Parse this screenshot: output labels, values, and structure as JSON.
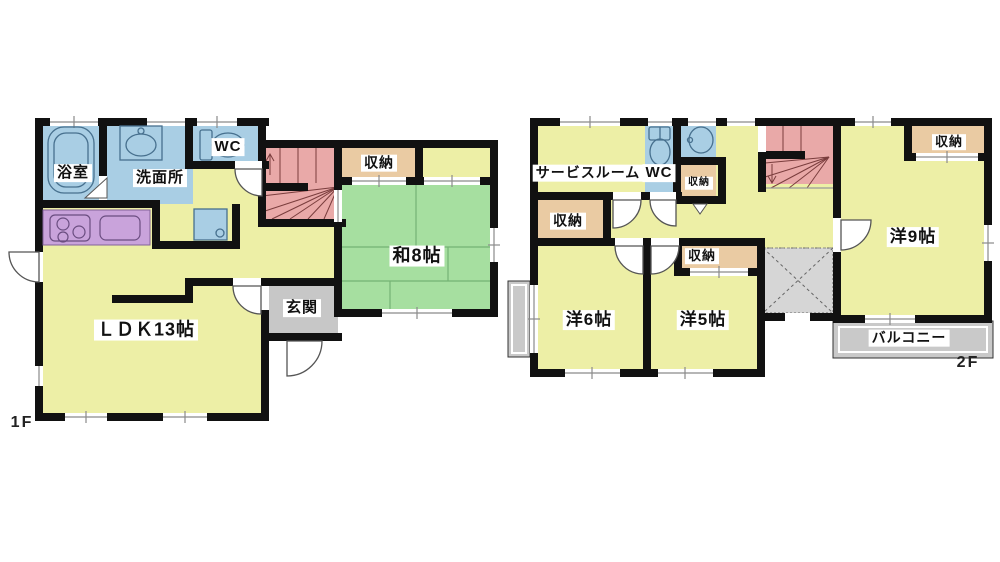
{
  "title": "floor-plan",
  "floors": {
    "f1": {
      "tag": "1F",
      "rooms": {
        "bath": "浴室",
        "wash": "洗面所",
        "wc": "WC",
        "storage": "収納",
        "washitsu": "和8帖",
        "genkan": "玄関",
        "ldk": "ＬＤＫ13帖"
      }
    },
    "f2": {
      "tag": "2F",
      "rooms": {
        "service": "サービスルーム",
        "wc": "WC",
        "storage_small": "収納",
        "storage_left": "収納",
        "storage_mid": "収納",
        "storage_top_right": "収納",
        "yo9": "洋9帖",
        "yo6": "洋6帖",
        "yo5": "洋5帖",
        "balcony": "バルコニー"
      }
    }
  },
  "colors": {
    "wall": "#111111",
    "room_yellow": "#EDEFA6",
    "tatami_green": "#A6DFA0",
    "water_blue": "#A9CEE4",
    "stair_pink": "#E9A9A8",
    "storage_tan": "#EACBA3",
    "kitchen_purple": "#C9A3DB",
    "entry_gray": "#C7C7C7",
    "balcony_gray": "#C9C9C9",
    "void_gray": "#D6D6D6"
  }
}
